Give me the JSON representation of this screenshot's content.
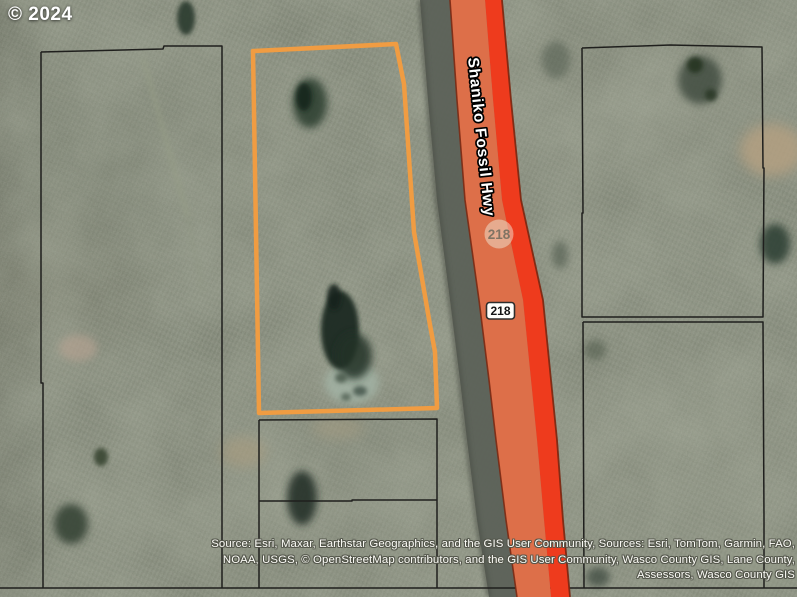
{
  "map": {
    "copyright": "© 2024",
    "road": {
      "name": "Shaniko Fossil Hwy",
      "route_number": "218"
    },
    "badges": {
      "faded": "218",
      "shield": "218"
    },
    "attribution": {
      "line1": "Source: Esri, Maxar, Earthstar Geographics, and the GIS User Community, Sources: Esri, TomTom, Garmin, FAO,",
      "line2": "NOAA, USGS, © OpenStreetMap contributors, and the GIS User Community, Wasco County GIS, Lane County,",
      "line3": "Assessors, Wasco County GIS"
    },
    "colors": {
      "parcel_highlight": "#f09c42",
      "highway_fill": "#dd6f49",
      "highway_stripe": "#ee3b1d",
      "parcel_line": "#1f1f1d",
      "terrain_base": "#7b8171"
    }
  }
}
